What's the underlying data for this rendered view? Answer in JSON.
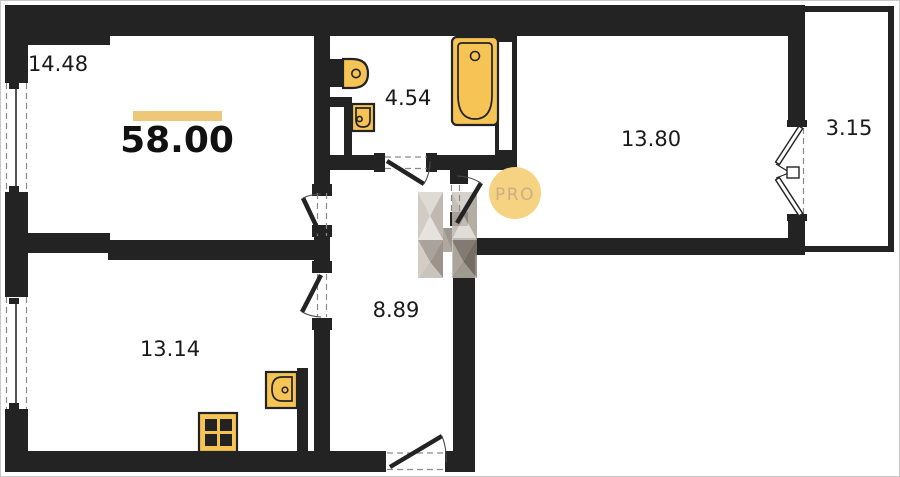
{
  "title": "Apartment floor plan",
  "total_area": {
    "value": "58.00"
  },
  "rooms": [
    {
      "name": "living-room",
      "area": "14.48"
    },
    {
      "name": "bathroom",
      "area": "4.54"
    },
    {
      "name": "bedroom",
      "area": "13.80"
    },
    {
      "name": "balcony",
      "area": "3.15"
    },
    {
      "name": "hallway",
      "area": "8.89"
    },
    {
      "name": "kitchen",
      "area": "13.14"
    }
  ],
  "watermark": {
    "badge": "PRO",
    "logo": "h-letter-watermark"
  },
  "fixtures": [
    "bathtub-icon",
    "toilet-icon",
    "washbasin-icon",
    "kitchen-sink-icon",
    "stove-icon"
  ],
  "colors": {
    "wall": "#232323",
    "fixture": "#F6C454",
    "area_bar": "#EDC878",
    "badge_fill": "#F6D383",
    "badge_text": "#C8B085",
    "label": "#1a1a1a"
  }
}
